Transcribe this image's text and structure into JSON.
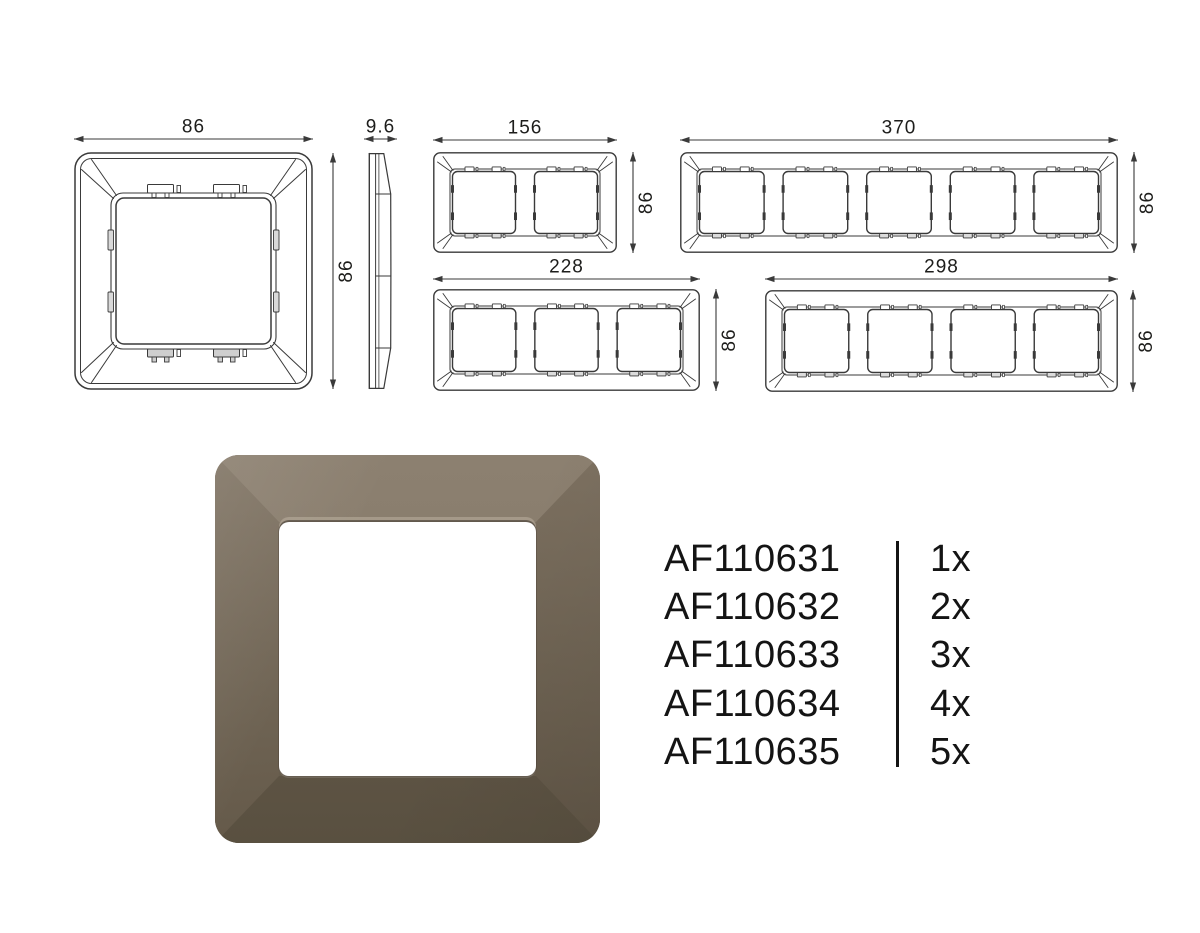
{
  "sheet": {
    "background": "#ffffff",
    "line_color": "#3a3a3a",
    "dim_text_color": "#1d1d1b"
  },
  "views": {
    "front_1gang": {
      "gangs": 1,
      "width_mm": "86",
      "height_mm": "86"
    },
    "side_profile": {
      "depth_mm": "9.6"
    },
    "gang2": {
      "gangs": 2,
      "width_mm": "156",
      "height_mm": "86"
    },
    "gang3": {
      "gangs": 3,
      "width_mm": "228",
      "height_mm": "86"
    },
    "gang4": {
      "gangs": 4,
      "width_mm": "298",
      "height_mm": "86"
    },
    "gang5": {
      "gangs": 5,
      "width_mm": "370",
      "height_mm": "86"
    }
  },
  "product": {
    "description": "1-gang frame render",
    "frame_color_light": "#8c8070",
    "frame_color_base": "#7a6e5d",
    "frame_color_dark": "#595040",
    "window_color": "#ffffff"
  },
  "parts": [
    {
      "code": "AF110631",
      "qty": "1x"
    },
    {
      "code": "AF110632",
      "qty": "2x"
    },
    {
      "code": "AF110633",
      "qty": "3x"
    },
    {
      "code": "AF110634",
      "qty": "4x"
    },
    {
      "code": "AF110635",
      "qty": "5x"
    }
  ]
}
